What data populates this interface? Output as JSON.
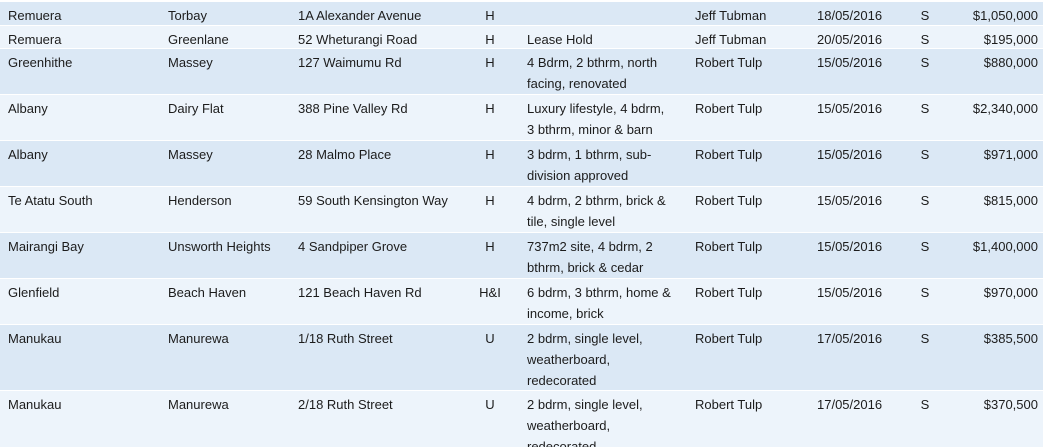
{
  "colors": {
    "row_band_blue": "#dbe8f5",
    "row_band_light": "#edf4fb",
    "grid_line": "#ffffff",
    "text": "#1c1c1c"
  },
  "table": {
    "rows": [
      {
        "suburb": "Remuera",
        "district": "Torbay",
        "address": "1A Alexander Avenue",
        "type": "H",
        "description": "",
        "agent": "Jeff Tubman",
        "date": "18/05/2016",
        "status": "S",
        "price": "$1,050,000"
      },
      {
        "suburb": "Remuera",
        "district": "Greenlane",
        "address": "52 Wheturangi Road",
        "type": "H",
        "description": "Lease Hold",
        "agent": "Jeff Tubman",
        "date": "20/05/2016",
        "status": "S",
        "price": "$195,000"
      },
      {
        "suburb": "Greenhithe",
        "district": "Massey",
        "address": "127 Waimumu Rd",
        "type": "H",
        "description": "4 Bdrm, 2 bthrm, north facing, renovated",
        "agent": "Robert Tulp",
        "date": "15/05/2016",
        "status": "S",
        "price": "$880,000"
      },
      {
        "suburb": "Albany",
        "district": "Dairy Flat",
        "address": "388 Pine Valley Rd",
        "type": "H",
        "description": "Luxury lifestyle, 4 bdrm, 3 bthrm, minor & barn",
        "agent": "Robert Tulp",
        "date": "15/05/2016",
        "status": "S",
        "price": "$2,340,000"
      },
      {
        "suburb": "Albany",
        "district": "Massey",
        "address": "28 Malmo Place",
        "type": "H",
        "description": "3 bdrm, 1 bthrm, sub-division approved",
        "agent": "Robert Tulp",
        "date": "15/05/2016",
        "status": "S",
        "price": "$971,000"
      },
      {
        "suburb": "Te Atatu South",
        "district": "Henderson",
        "address": "59 South Kensington Way",
        "type": "H",
        "description": "4 bdrm, 2 bthrm, brick & tile, single level",
        "agent": "Robert Tulp",
        "date": "15/05/2016",
        "status": "S",
        "price": "$815,000"
      },
      {
        "suburb": "Mairangi Bay",
        "district": "Unsworth Heights",
        "address": "4 Sandpiper Grove",
        "type": "H",
        "description": "737m2 site, 4 bdrm, 2 bthrm, brick & cedar",
        "agent": "Robert Tulp",
        "date": "15/05/2016",
        "status": "S",
        "price": "$1,400,000"
      },
      {
        "suburb": "Glenfield",
        "district": "Beach Haven",
        "address": "121 Beach Haven Rd",
        "type": "H&I",
        "description": "6 bdrm, 3 bthrm, home & income, brick",
        "agent": "Robert Tulp",
        "date": "15/05/2016",
        "status": "S",
        "price": "$970,000"
      },
      {
        "suburb": "Manukau",
        "district": "Manurewa",
        "address": "1/18 Ruth Street",
        "type": "U",
        "description": "2 bdrm, single level, weatherboard, redecorated",
        "agent": "Robert Tulp",
        "date": "17/05/2016",
        "status": "S",
        "price": "$385,500"
      },
      {
        "suburb": "Manukau",
        "district": "Manurewa",
        "address": "2/18 Ruth Street",
        "type": "U",
        "description": "2 bdrm, single level, weatherboard, redecorated",
        "agent": "Robert Tulp",
        "date": "17/05/2016",
        "status": "S",
        "price": "$370,500"
      }
    ]
  }
}
